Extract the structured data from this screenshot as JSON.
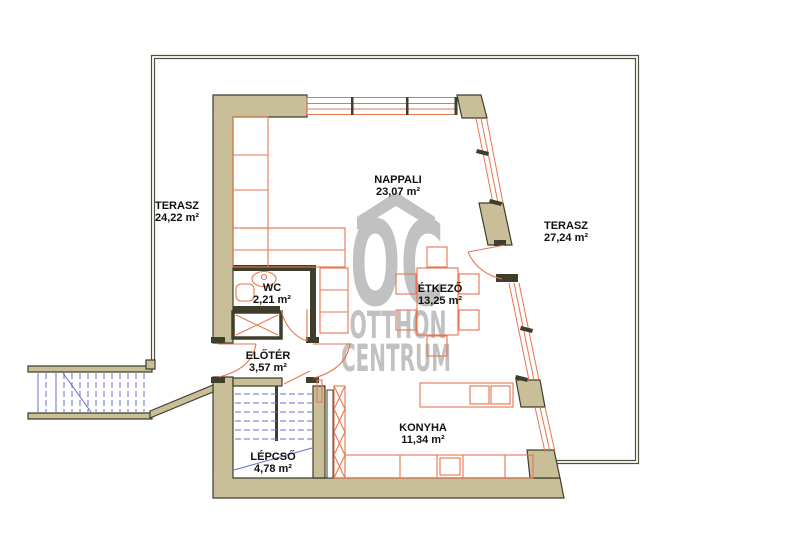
{
  "plan": {
    "watermark": {
      "logo": "OC",
      "line1": "OTTHON",
      "line2": "CENTRUM"
    },
    "rooms": [
      {
        "id": "terasz-left",
        "name": "TERASZ",
        "area": "24,22 m²"
      },
      {
        "id": "nappali",
        "name": "NAPPALI",
        "area": "23,07 m²"
      },
      {
        "id": "terasz-right",
        "name": "TERASZ",
        "area": "27,24 m²"
      },
      {
        "id": "wc",
        "name": "WC",
        "area": "2,21 m²"
      },
      {
        "id": "etkezo",
        "name": "ÉTKEZŐ",
        "area": "13,25 m²"
      },
      {
        "id": "eloter",
        "name": "ELŐTÉR",
        "area": "3,57 m²"
      },
      {
        "id": "konyha",
        "name": "KONYHA",
        "area": "11,34 m²"
      },
      {
        "id": "lepcso",
        "name": "LÉPCSŐ",
        "area": "4,78 m²"
      }
    ],
    "colors": {
      "wall_fill": "#c8bf99",
      "wall_stroke": "#3f3d2c",
      "boundary": "#50503c",
      "furniture": "#e8754f",
      "stairs": "#6b6bd0",
      "watermark": "#c1c1c1",
      "label": "#111111"
    }
  }
}
